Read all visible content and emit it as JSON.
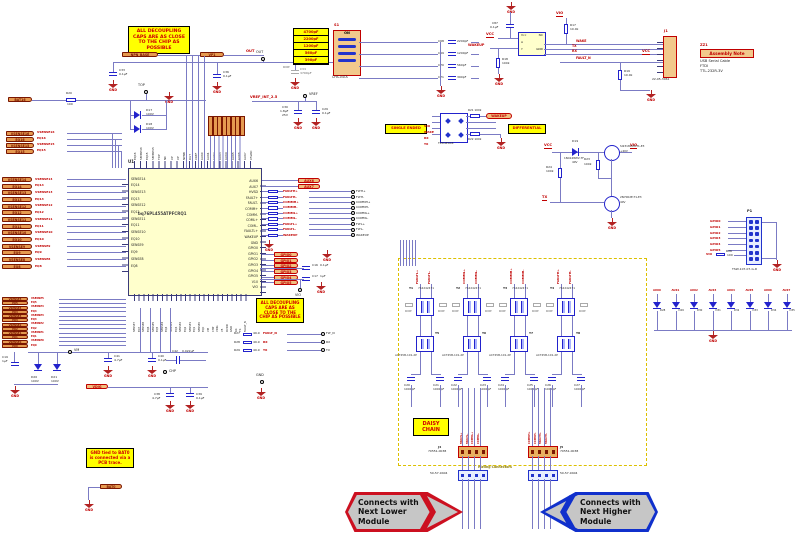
{
  "labels": {
    "gnd": "GND",
    "vcc": "VCC",
    "vio": "VIO",
    "vdig": "VDIG",
    "tx": "TX",
    "rx": "RX",
    "wake": "WAKE",
    "wakeup": "WAKEUP",
    "fault_n": "FAULT_N",
    "out": "OUT",
    "top": "TOP",
    "vm": "VM",
    "chp": "CHP",
    "vref": "VREF",
    "dnp": "DNP",
    "on": "ON",
    "hvsd": "HVSD",
    "u1": "U1",
    "p1": "P1",
    "j1": "J1",
    "u2": "U2",
    "s1": "S1",
    "vp1": "VP1",
    "npn_base": "NPN_BASE",
    "bat16": "BAT16",
    "bat0": "BAT0",
    "mating": "Mating Connectors"
  },
  "notes": {
    "decoupling": "ALL DECOUPLING CAPS ARE AS CLOSE TO THE CHIP AS POSSIBLE",
    "gnd_note": "GND tied to BAT0 is connected via a PCB trace.",
    "daisy": "DAISY CHAIN"
  },
  "assembly": {
    "ref": "ZZ1",
    "title": "Assembly Note",
    "lines": [
      "USB Serial Cable",
      "FTDI",
      "TTL-232R-3V"
    ]
  },
  "arrows": {
    "lower": {
      "lines": [
        "Connects with",
        "Next Lower",
        "Module"
      ]
    },
    "higher": {
      "lines": [
        "Connects with",
        "Next Higher",
        "Module"
      ]
    }
  },
  "ic": {
    "ref": "U1",
    "part": "bq76PL455ATPFCRQ1",
    "left_pins": [
      "SENSE14",
      "EQ14",
      "SENSE13",
      "EQ13",
      "SENSE12",
      "EQ12",
      "SENSE11",
      "EQ11",
      "SENSE10",
      "EQ10",
      "SENSE9",
      "EQ9",
      "SENSE8",
      "EQ8"
    ],
    "right_pins": [
      "AUX6",
      "AUX7",
      "HVSD",
      "FAULT+",
      "FAULT-",
      "COMM+",
      "COMM-",
      "COML+",
      "COML-",
      "FAULTL+",
      "WAKEUP",
      "GND",
      "GPIO0",
      "GPIO1",
      "GPIO2",
      "GPIO3",
      "GPIO4",
      "GPIO5",
      "V10",
      "VIO"
    ],
    "top_pins": [
      "EQ16",
      "SENSE16",
      "EQ15",
      "SENSE15",
      "TOP",
      "NC",
      "VP",
      "VP",
      "NPNB",
      "OUT",
      "VREF",
      "AUX0",
      "AUX1",
      "AUX2",
      "AUX3",
      "AUX4",
      "AUX5",
      "AUX6",
      "AUX7",
      "V5VAO"
    ],
    "bottom_pins": [
      "SENSE7",
      "EQ7",
      "SENSE6",
      "EQ6",
      "SENSE5",
      "EQ5",
      "SENSE4",
      "EQ4",
      "SENSE3",
      "EQ3",
      "SENSE2",
      "EQ2",
      "SENSE1",
      "EQ1",
      "SENSE0",
      "EQ0",
      "VM",
      "CHP",
      "VDIG",
      "V5",
      "DVDD",
      "GND",
      "RX",
      "TX",
      "FAULT_N"
    ]
  },
  "flags_a": [
    "VSENSE16",
    "EQ16",
    "VSENSE15",
    "EQ15"
  ],
  "flags_b": [
    "VSENSE14",
    "EQ14",
    "VSENSE13",
    "EQ13",
    "VSENSE12",
    "EQ12",
    "VSENSE11",
    "EQ11",
    "VSENSE10",
    "EQ10",
    "VSENSE9",
    "EQ9",
    "VSENSE8",
    "EQ8"
  ],
  "flags_c": [
    "VSENSE5",
    "EQ5",
    "VSENSE4",
    "EQ4",
    "VSENSE3",
    "EQ3",
    "VSENSE2",
    "EQ2",
    "VSENSE1",
    "EQ1",
    "VSENSE0",
    "EQ0"
  ],
  "top_left": {
    "r20": "R20",
    "r20v": "100",
    "c33": "C33",
    "c33v": "0.1µF",
    "c36": "C36",
    "c36v": "0.1µF",
    "d17": "D17",
    "d17v": "100V",
    "d18": "D18",
    "d18v": "100V"
  },
  "out_cluster": {
    "values": [
      "4700pF",
      "2200pF",
      "1200pF",
      "560pF",
      "390pF"
    ],
    "sw_part": "CHS-04TA",
    "dnp_cap": {
      "ref": "C34",
      "v": "4700pF"
    },
    "caps": [
      {
        "ref": "C68",
        "v": "2200pF"
      },
      {
        "ref": "C69",
        "v": "1200pF"
      },
      {
        "ref": "C70",
        "v": "560pF"
      },
      {
        "ref": "C71",
        "v": "390pF"
      }
    ]
  },
  "vref_cluster": {
    "net": "VREF_INT_2.5",
    "c30": "C30",
    "c30v": "1.8µF",
    "c30v2": "25V",
    "c29": "C29",
    "c29v": "0.1µF"
  },
  "wake_cluster": {
    "c87": "C87",
    "c87v": "0.1µF",
    "r18": "R18",
    "r18v": "100k",
    "r17": "R17",
    "r17v": "10.0k",
    "r19": "R19",
    "r19v": "10.0k",
    "u2_pins": {
      "vcc": "Vcc",
      "nc": "NC",
      "a": "A",
      "y": "Y",
      "gnd": "GND"
    },
    "j1_part": "22-05-3061"
  },
  "fet_cluster": {
    "d19": "D19",
    "d19p": "1N4148WV-7F",
    "d19v": "40V",
    "q2p": "SI2318CDS-T1-E3",
    "q2v": "+40V",
    "q1p": "2N7002E-T1-E3",
    "q1v": "40V",
    "r23": "R23",
    "r23v": "100k",
    "r24": "R24",
    "r24v": "100k"
  },
  "esd_cluster": {
    "left_label": "SINGLE ENDED",
    "right_label": "DIFFERENTIAL",
    "part": "TPD4E004",
    "r21": "R21 100k",
    "r22": "R22 100k",
    "nets": [
      "VIO",
      "WAKE",
      "RX",
      "TX"
    ]
  },
  "p1_cluster": {
    "part": "TSW-107-07-G-D",
    "rows": [
      "GPIO0",
      "GPIO1",
      "GPIO2",
      "GPIO3",
      "GPIO4",
      "GPIO5"
    ],
    "r26": "R26",
    "r26v": "100"
  },
  "comm_rows": [
    {
      "net": "FAULTH+",
      "tp": "FLTH+"
    },
    {
      "net": "FAULTH-",
      "tp": "FLTH-"
    },
    {
      "net": "COMMH+",
      "tp": "COMMH+"
    },
    {
      "net": "COMMH-",
      "tp": "COMMH-"
    },
    {
      "net": "COMML+",
      "tp": "COMML+"
    },
    {
      "net": "COMML-",
      "tp": "COMML-"
    },
    {
      "net": "FAULTL+",
      "tp": "FLTL+"
    },
    {
      "net": "FAULTL-",
      "tp": "FLTL-"
    },
    {
      "net": "WAKEUP",
      "tp": "WAKEUP"
    }
  ],
  "gpio_flags": [
    "GPIO0",
    "GPIO1",
    "GPIO2",
    "GPIO3",
    "GPIO4",
    "GPIO5"
  ],
  "aux_flags": [
    "AUX6",
    "AUX7"
  ],
  "vio_caps": {
    "c16": "C16",
    "c16v": "0.1µF",
    "c17": "C17",
    "c17v": "1µF"
  },
  "uart_rows": [
    {
      "r": "R27",
      "rv": "49.9",
      "net": "FAULT_N",
      "tp": "FLT_N"
    },
    {
      "r": "R28",
      "rv": "49.9",
      "net": "RX",
      "tp": "RX"
    },
    {
      "r": "R29",
      "rv": "49.9",
      "net": "TX",
      "tp": "TX"
    }
  ],
  "bottom_left": {
    "c19": "C19",
    "c19v": "1µF",
    "d20": "D20",
    "d20v": "100V",
    "d21": "D21",
    "d21v": "100V",
    "c41": "C41",
    "c41v": "4.7µF",
    "c40": "C40",
    "c40v": "0.1µF",
    "c42": "C42",
    "c42v": "0.022µF",
    "c38": "C38",
    "c38v": "4.7µF",
    "c39": "C39",
    "c39v": "0.1µF"
  },
  "diode_row": [
    {
      "ref": "D28",
      "net": "AUX0"
    },
    {
      "ref": "D29",
      "net": "AUX1"
    },
    {
      "ref": "D30",
      "net": "AUX2"
    },
    {
      "ref": "D31",
      "net": "AUX3"
    },
    {
      "ref": "D32",
      "net": "AUX4"
    },
    {
      "ref": "D33",
      "net": "AUX5"
    },
    {
      "ref": "D34",
      "net": "AUX6"
    },
    {
      "ref": "D35",
      "net": "AUX7"
    }
  ],
  "daisy": {
    "columns": [
      {
        "ref": "T1",
        "part": "744242471",
        "choke_ref": "T5",
        "choke_part": "ACT45B-101-2P",
        "net_p": "FAULTL+",
        "net_n": "FAULTL-",
        "cap1": "C20",
        "cap2": "C21",
        "capv": "1000pF",
        "dnp": "DNP"
      },
      {
        "ref": "T2",
        "part": "744242471",
        "choke_ref": "T6",
        "choke_part": "ACT45B-101-2P",
        "net_p": "COMML+",
        "net_n": "COMML-",
        "cap1": "C22",
        "cap2": "C23",
        "capv": "1000pF",
        "dnp": "DNP"
      },
      {
        "ref": "T3",
        "part": "744242471",
        "choke_ref": "T7",
        "choke_part": "ACT45B-101-2P",
        "net_p": "COMMH+",
        "net_n": "COMMH-",
        "cap1": "C24",
        "cap2": "C25",
        "capv": "1000pF",
        "dnp": "DNP"
      },
      {
        "ref": "T4",
        "part": "744242471",
        "choke_ref": "T8",
        "choke_part": "ACT45B-101-2P",
        "net_p": "FAULTH+",
        "net_n": "FAULTH-",
        "cap1": "C26",
        "cap2": "C27",
        "capv": "1000pF",
        "dnp": "DNP"
      }
    ],
    "j4": {
      "ref": "J4",
      "part": "70551-0038",
      "stack": [
        "FAULTL+",
        "FAULTL-",
        "COMML+",
        "COMML-"
      ]
    },
    "j5": {
      "ref": "J5",
      "part": "70551-0038",
      "stack": [
        "COMMH+",
        "COMMH-",
        "FAULTH+",
        "FAULTH-"
      ]
    },
    "m1": "50-57-9404",
    "m2": "50-57-9404"
  }
}
